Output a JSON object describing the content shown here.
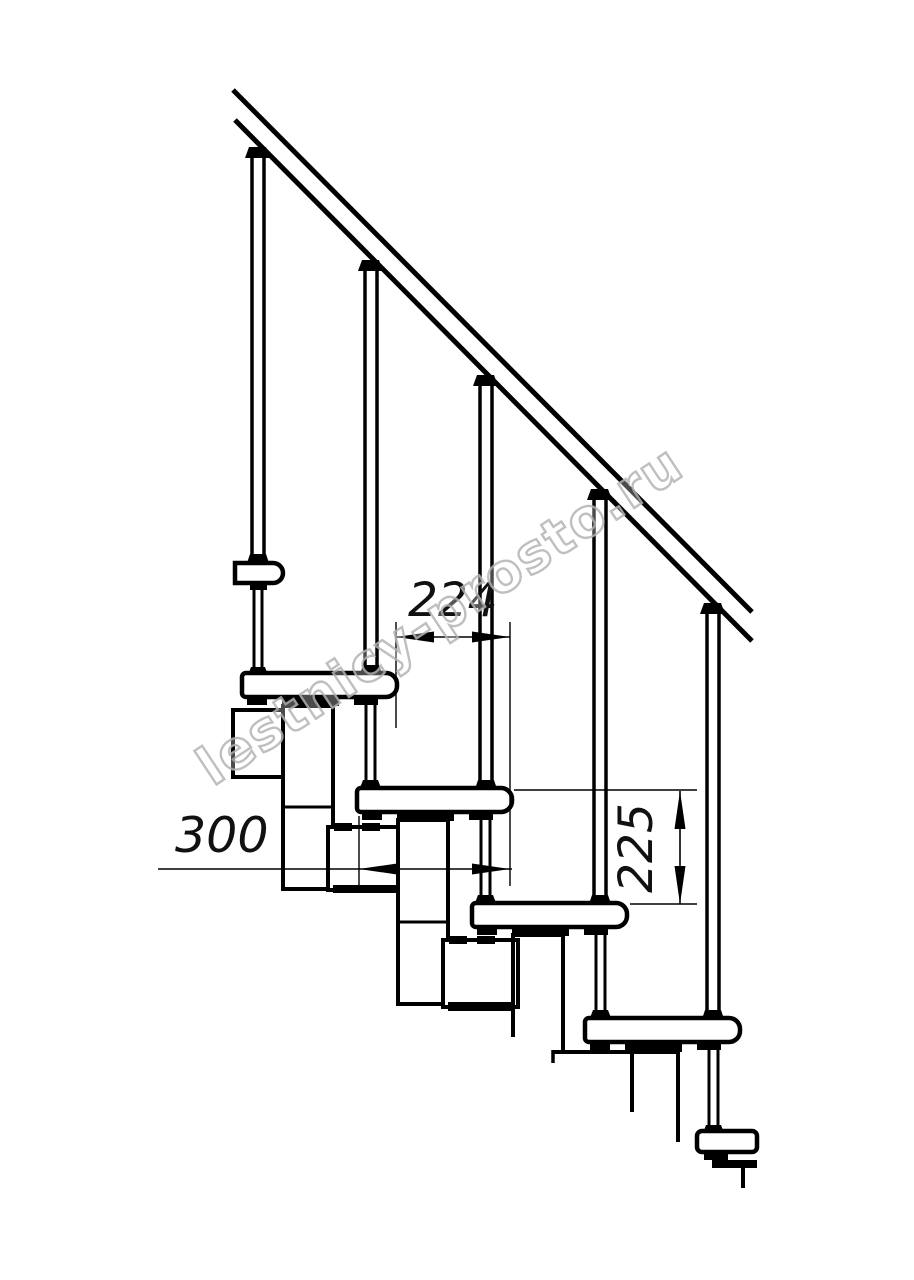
{
  "document": {
    "type": "technical-drawing",
    "subject": "modular staircase side elevation fragment",
    "background_color": "#ffffff",
    "line_color": "#000000",
    "units": "mm"
  },
  "dimensions": {
    "step_run": "224",
    "tread_depth": "300",
    "step_rise": "225"
  },
  "watermark": {
    "text": "lestnicy-prosto.ru",
    "color": "#b5b5b5"
  },
  "structure": {
    "balusters_visible": 5,
    "treads_visible": 6,
    "handrail": "diagonal band upper-left to mid-right"
  }
}
